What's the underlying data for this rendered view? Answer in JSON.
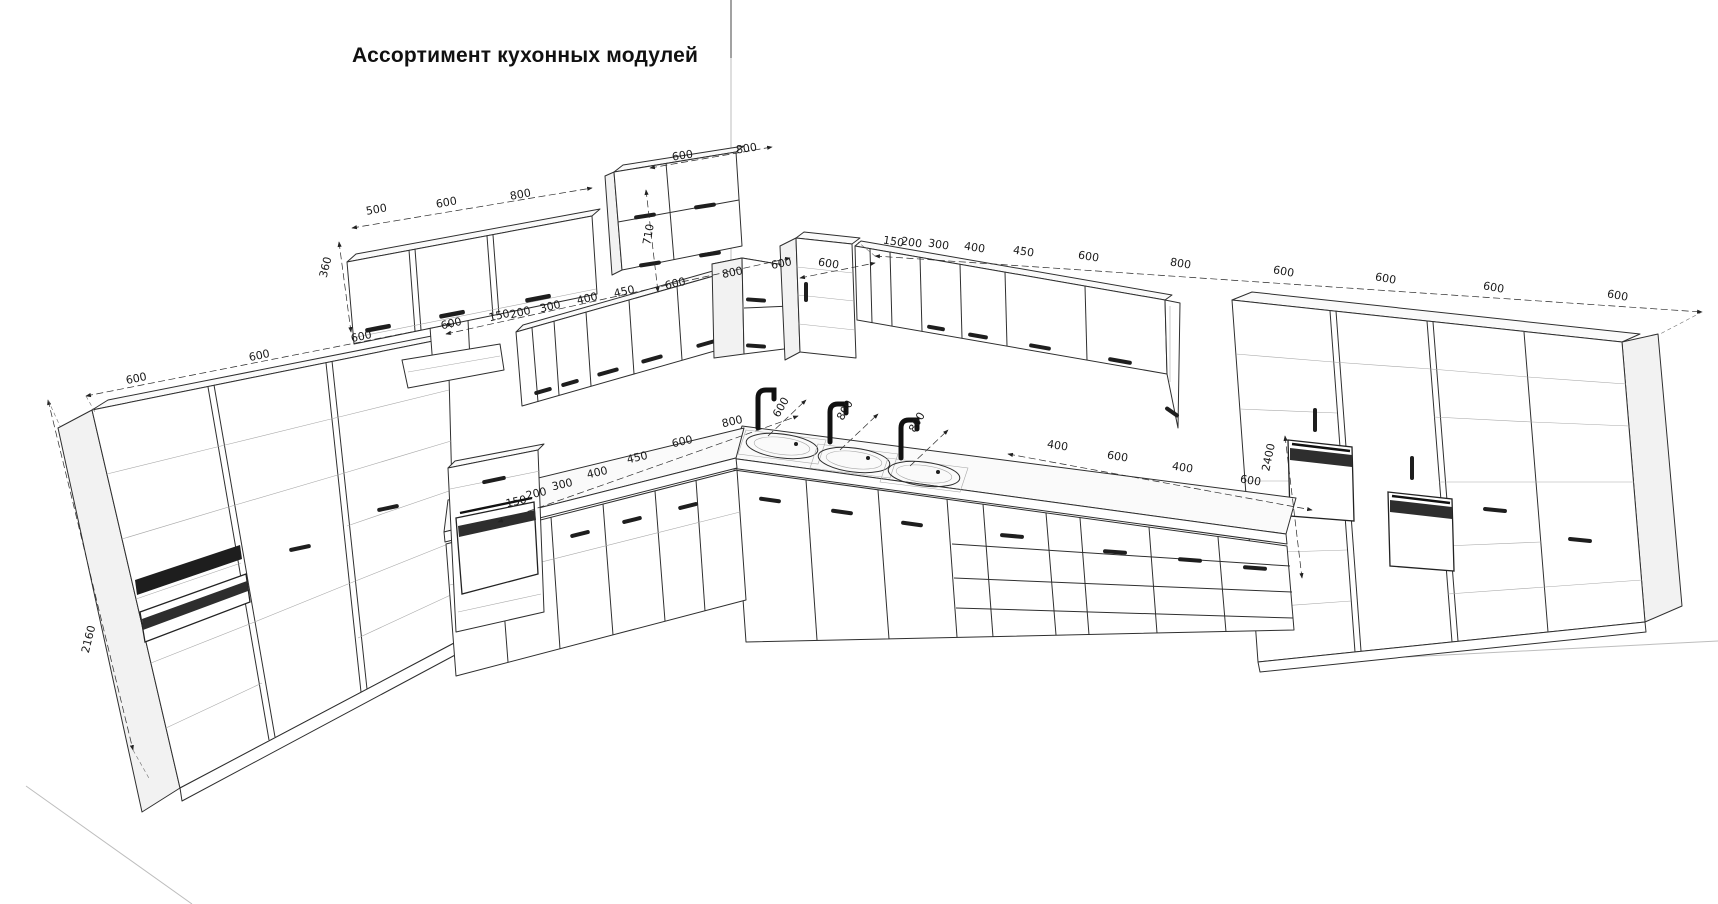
{
  "title": "Ассортимент кухонных модулей",
  "units": "mm",
  "colors": {
    "background": "#ffffff",
    "line": "#2f2f2f",
    "dim_line": "#2a2a2a",
    "dim_text": "#1a1a1a",
    "appliance_dark": "#1e1e1e",
    "side_shade": "#f2f2f2"
  },
  "modules": [
    {
      "group": "left-tall-cabinets",
      "widths_mm": [
        600,
        600,
        600
      ],
      "height_mm": 2160
    },
    {
      "group": "left-wall-cabinets",
      "widths_mm": [
        500,
        600,
        800
      ],
      "height_mm": 360
    },
    {
      "group": "middle-wall-cabinet",
      "widths_mm": [
        600,
        800
      ],
      "height_mm": 710
    },
    {
      "group": "left-second-wall-row",
      "widths_mm": [
        600,
        150,
        200,
        300,
        400,
        450,
        600,
        800,
        600
      ]
    },
    {
      "group": "right-wall-cabinets",
      "widths_mm": [
        600,
        150,
        200,
        300,
        400,
        450,
        600,
        800,
        600,
        600,
        600,
        600
      ]
    },
    {
      "group": "left-base-cabinets",
      "widths_mm": [
        150,
        200,
        300,
        400,
        450,
        600
      ]
    },
    {
      "group": "corner-sink-base",
      "widths_mm": [
        800,
        600,
        800,
        800
      ]
    },
    {
      "group": "right-base-cabinets",
      "widths_mm": [
        400,
        600,
        400,
        600
      ]
    },
    {
      "group": "right-tall-cabinets",
      "height_mm": 2400
    }
  ],
  "dimension_labels": [
    {
      "text": "600",
      "x": 137,
      "y": 382,
      "rot": -12
    },
    {
      "text": "600",
      "x": 260,
      "y": 359,
      "rot": -12
    },
    {
      "text": "600",
      "x": 362,
      "y": 340,
      "rot": -12
    },
    {
      "text": "2160",
      "x": 92,
      "y": 640,
      "rot": -76
    },
    {
      "text": "360",
      "x": 329,
      "y": 268,
      "rot": -76
    },
    {
      "text": "500",
      "x": 377,
      "y": 213,
      "rot": -10
    },
    {
      "text": "600",
      "x": 447,
      "y": 206,
      "rot": -10
    },
    {
      "text": "800",
      "x": 521,
      "y": 198,
      "rot": -10
    },
    {
      "text": "710",
      "x": 652,
      "y": 235,
      "rot": -80
    },
    {
      "text": "600",
      "x": 683,
      "y": 159,
      "rot": -9
    },
    {
      "text": "800",
      "x": 747,
      "y": 152,
      "rot": -9
    },
    {
      "text": "600",
      "x": 452,
      "y": 327,
      "rot": -13
    },
    {
      "text": "150",
      "x": 500,
      "y": 319,
      "rot": -13
    },
    {
      "text": "200",
      "x": 521,
      "y": 316,
      "rot": -13
    },
    {
      "text": "300",
      "x": 551,
      "y": 310,
      "rot": -13
    },
    {
      "text": "400",
      "x": 588,
      "y": 302,
      "rot": -13
    },
    {
      "text": "450",
      "x": 625,
      "y": 295,
      "rot": -13
    },
    {
      "text": "600",
      "x": 676,
      "y": 287,
      "rot": -13
    },
    {
      "text": "800",
      "x": 733,
      "y": 276,
      "rot": -11
    },
    {
      "text": "600",
      "x": 782,
      "y": 267,
      "rot": -11
    },
    {
      "text": "600",
      "x": 828,
      "y": 267,
      "rot": 9
    },
    {
      "text": "150",
      "x": 893,
      "y": 245,
      "rot": 9
    },
    {
      "text": "200",
      "x": 911,
      "y": 246,
      "rot": 9
    },
    {
      "text": "300",
      "x": 938,
      "y": 248,
      "rot": 9
    },
    {
      "text": "400",
      "x": 974,
      "y": 251,
      "rot": 9
    },
    {
      "text": "450",
      "x": 1023,
      "y": 255,
      "rot": 9
    },
    {
      "text": "600",
      "x": 1088,
      "y": 260,
      "rot": 9
    },
    {
      "text": "800",
      "x": 1180,
      "y": 267,
      "rot": 9
    },
    {
      "text": "600",
      "x": 1283,
      "y": 275,
      "rot": 10
    },
    {
      "text": "600",
      "x": 1385,
      "y": 282,
      "rot": 10
    },
    {
      "text": "600",
      "x": 1493,
      "y": 291,
      "rot": 10
    },
    {
      "text": "600",
      "x": 1617,
      "y": 299,
      "rot": 10
    },
    {
      "text": "150",
      "x": 517,
      "y": 505,
      "rot": -13
    },
    {
      "text": "200",
      "x": 537,
      "y": 497,
      "rot": -13
    },
    {
      "text": "300",
      "x": 563,
      "y": 488,
      "rot": -13
    },
    {
      "text": "400",
      "x": 598,
      "y": 476,
      "rot": -13
    },
    {
      "text": "450",
      "x": 638,
      "y": 461,
      "rot": -13
    },
    {
      "text": "600",
      "x": 683,
      "y": 445,
      "rot": -13
    },
    {
      "text": "800",
      "x": 733,
      "y": 425,
      "rot": -13
    },
    {
      "text": "600",
      "x": 784,
      "y": 409,
      "rot": -60
    },
    {
      "text": "800",
      "x": 848,
      "y": 412,
      "rot": -60
    },
    {
      "text": "800",
      "x": 920,
      "y": 424,
      "rot": -60
    },
    {
      "text": "400",
      "x": 1057,
      "y": 449,
      "rot": 9
    },
    {
      "text": "600",
      "x": 1117,
      "y": 460,
      "rot": 9
    },
    {
      "text": "400",
      "x": 1182,
      "y": 471,
      "rot": 9
    },
    {
      "text": "600",
      "x": 1250,
      "y": 484,
      "rot": 9
    },
    {
      "text": "2400",
      "x": 1272,
      "y": 458,
      "rot": -78
    }
  ]
}
